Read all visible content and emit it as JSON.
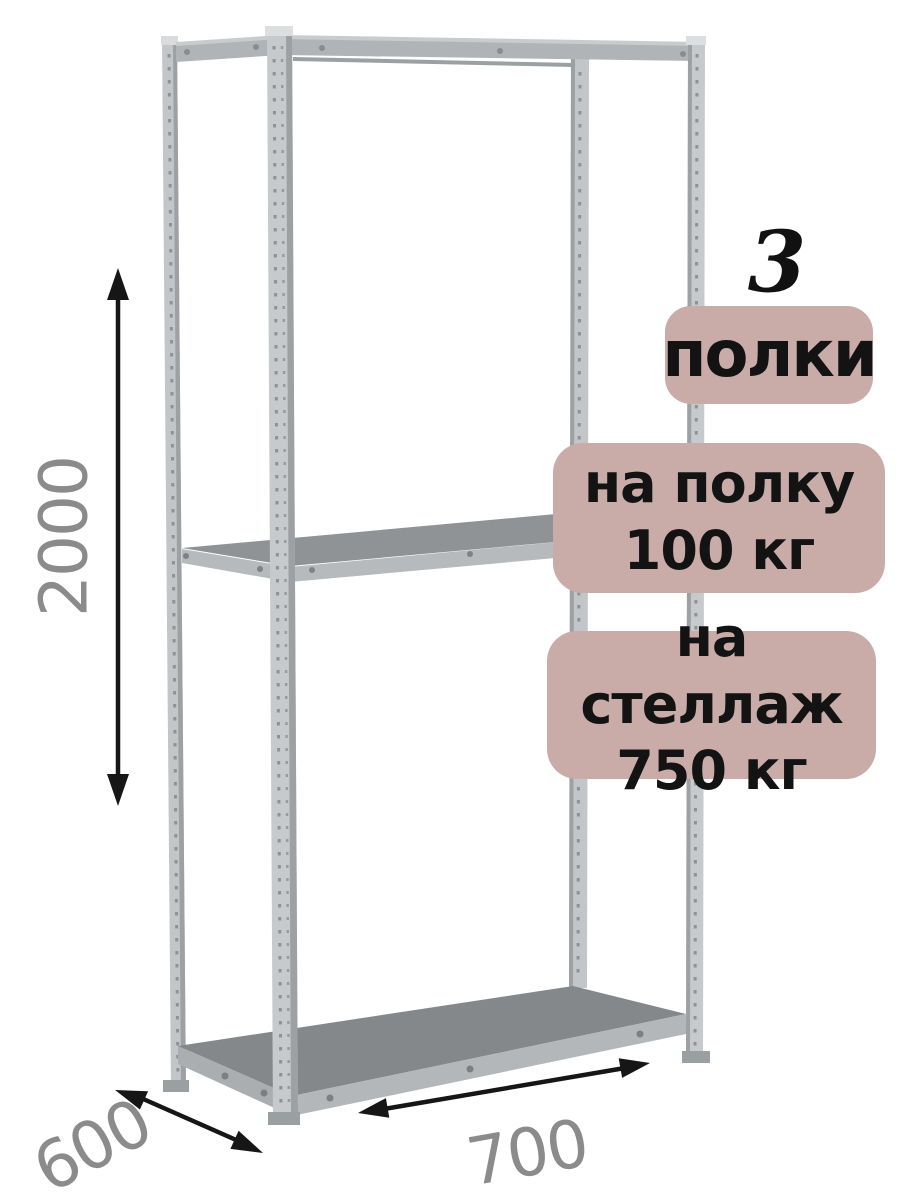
{
  "product": {
    "illustration": "metal-shelving-rack-3d-view",
    "shelf_count_visible_shelves": 3
  },
  "dimensions": {
    "height": "2000",
    "depth": "600",
    "width": "700"
  },
  "badges": {
    "shelf_count": {
      "number": "3",
      "label": "полки"
    },
    "per_shelf": {
      "line1": "на полку",
      "line2": "100 кг"
    },
    "per_rack": {
      "line1": "на стеллаж",
      "line2": "750 кг"
    }
  },
  "colors": {
    "background": "#ffffff",
    "badge_background": "#c9aca8",
    "badge_text": "#131313",
    "dimension_text": "#8b8b8b",
    "arrow": "#161616",
    "metal_light": "#c6c9cb",
    "metal_edge": "#9da1a3",
    "shelf_surface": "#85888a",
    "shelf_fascia": "#b4b7b9"
  }
}
